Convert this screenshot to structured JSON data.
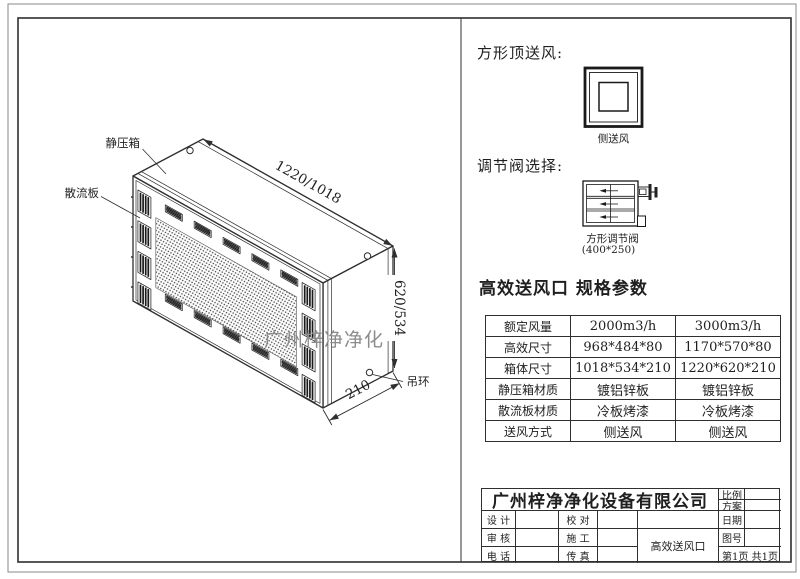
{
  "colors": {
    "line": "#2f2f2f",
    "watermark_gray": "#8c8c8c",
    "mesh_dot": "#3d3d3d"
  },
  "drawing": {
    "labels": {
      "static_pressure_box": "静压箱",
      "diffuser_plate": "散流板",
      "lifting_ring": "吊环",
      "watermark": "广州梓净净化"
    },
    "dimensions": {
      "length": "1220/1018",
      "height": "620/534",
      "depth": "210"
    }
  },
  "right_panel": {
    "top_supply": {
      "heading": "方形顶送风:",
      "caption": "侧送风"
    },
    "valve": {
      "heading": "调节阀选择:",
      "caption_line1": "方形调节阀",
      "caption_line2": "(400*250)"
    },
    "spec": {
      "heading": "高效送风口 规格参数",
      "table": {
        "rows": [
          {
            "label": "额定风量",
            "v1": "2000m3/h",
            "v2": "3000m3/h"
          },
          {
            "label": "高效尺寸",
            "v1": "968*484*80",
            "v2": "1170*570*80"
          },
          {
            "label": "箱体尺寸",
            "v1": "1018*534*210",
            "v2": "1220*620*210"
          },
          {
            "label": "静压箱材质",
            "v1": "镀铝锌板",
            "v2": "镀铝锌板"
          },
          {
            "label": "散流板材质",
            "v1": "冷板烤漆",
            "v2": "冷板烤漆"
          },
          {
            "label": "送风方式",
            "v1": "侧送风",
            "v2": "侧送风"
          }
        ]
      }
    }
  },
  "title_block": {
    "company": "广州梓净净化设备有限公司",
    "scale_label": "比例",
    "plan_label": "方案",
    "design_label": "设 计",
    "check_label": "校 对",
    "date_label": "日期",
    "audit_label": "审 核",
    "construct_label": "施 工",
    "drawing_no_label": "图号",
    "phone_label": "电 话",
    "fax_label": "传 真",
    "product_name": "高效送风口",
    "page_info": "第1页 共1页"
  }
}
